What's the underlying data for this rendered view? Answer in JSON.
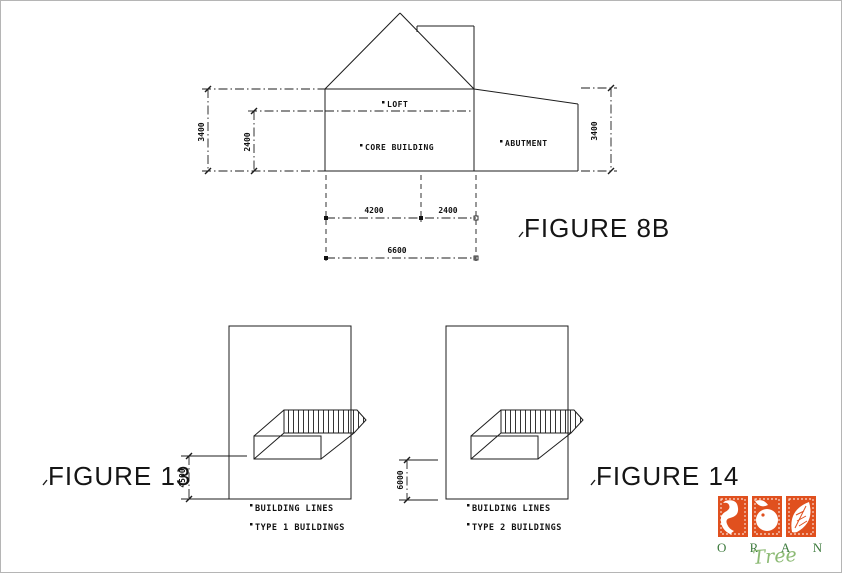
{
  "figure_8b": {
    "label": "FIGURE 8B",
    "areas": {
      "loft": "LOFT",
      "core": "CORE BUILDING",
      "abutment": "ABUTMENT"
    },
    "dimensions": {
      "left_outer_height": "3400",
      "left_inner_height": "2400",
      "right_height": "3400",
      "bottom_core_width": "4200",
      "bottom_abutment_width": "2400",
      "bottom_total_width": "6600"
    }
  },
  "figure_13": {
    "label": "FIGURE 13",
    "dimension_building_line": "4500",
    "notes": [
      "BUILDING LINES",
      "TYPE 1 BUILDINGS"
    ]
  },
  "figure_14": {
    "label": "FIGURE 14",
    "dimension_building_line": "6000",
    "notes": [
      "BUILDING LINES",
      "TYPE 2 BUILDINGS"
    ]
  },
  "logo": {
    "brand": "O R A N G E",
    "brand_script": "Tree",
    "colors": {
      "orange": "#e0501e",
      "green": "#3e7b3e",
      "script_green": "#8cba74",
      "white": "#ffffff"
    }
  }
}
